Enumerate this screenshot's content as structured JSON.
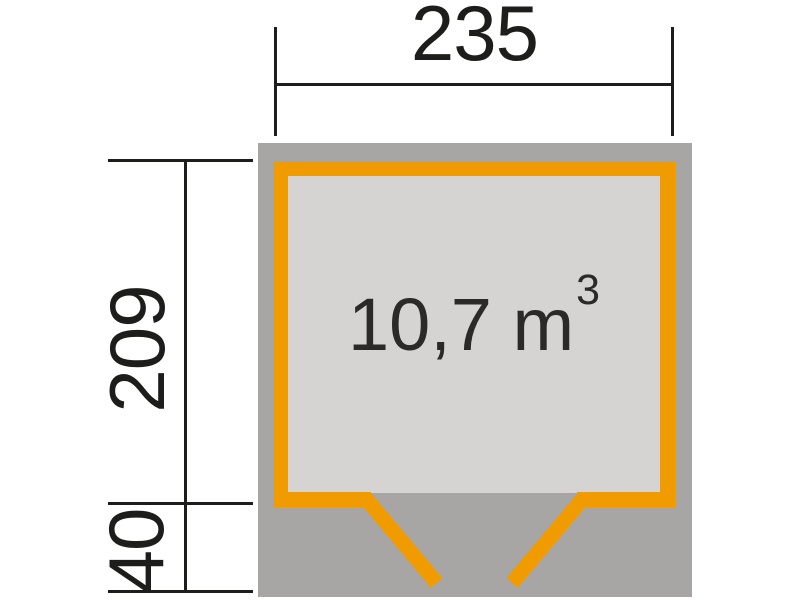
{
  "diagram": {
    "type": "shed-floor-plan",
    "dimensions": {
      "width": "235",
      "height": "209",
      "front_depth": "40",
      "volume": "10,7 m",
      "volume_superscript": "3"
    },
    "colors": {
      "wall_orange": "#f09b00",
      "footprint_gray": "#a8a6a5",
      "interior_gray": "#d5d4d2",
      "line_black": "#1d1d1b",
      "background": "#ffffff"
    }
  }
}
